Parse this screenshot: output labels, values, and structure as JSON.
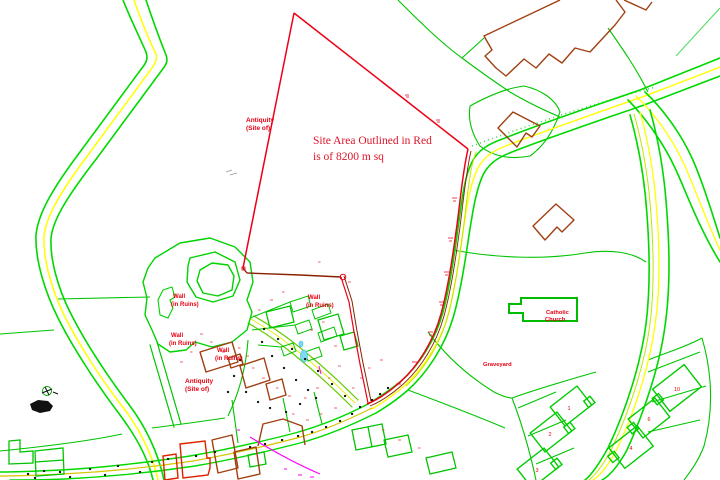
{
  "map_note": {
    "line1": "Site Area Outlined in Red",
    "line2": "is of 8200 m sq"
  },
  "labels": {
    "antiquity": {
      "line1": "Antiquity",
      "line2": "(Site of)"
    },
    "wall_ruins": {
      "line1": "Wall",
      "line2": "(in Ruins)"
    },
    "graveyard": "Graveyard",
    "church": {
      "line1": "Catholic",
      "line2": "Church"
    }
  },
  "estate": {
    "houses": [
      {
        "number": "1"
      },
      {
        "number": "2"
      },
      {
        "number": "3"
      },
      {
        "number": "4"
      },
      {
        "number": "6"
      },
      {
        "number": "10"
      }
    ]
  },
  "palette": {
    "road_green": "#00d900",
    "boundary_green": "#00c400",
    "centerline_yellow": "#ffff00",
    "lane_yellow_green": "#bfe600",
    "street_ochre": "#d6c400",
    "site_outline_red": "#ec0016",
    "site_outline_dark": "#8b2000",
    "ruin_building_brown": "#a04012",
    "red_building": "#dd2200",
    "label_red": "#e60012",
    "water_cyan": "#7fd9ef",
    "service_magenta": "#ff00ff",
    "tree_black": "#111111"
  }
}
